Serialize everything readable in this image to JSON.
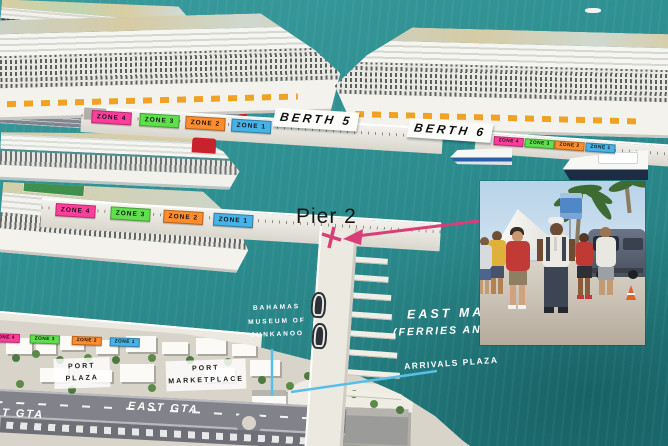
{
  "colors": {
    "water": "#2e8f91",
    "water_dark": "#1e7578",
    "pier": "#ece9e1",
    "land": "#d8d4ca",
    "road": "#81828a",
    "zone_pink": "#ff3d9c",
    "zone_green": "#5fdf4d",
    "zone_orange": "#ff8c2d",
    "zone_blue": "#45b2e8",
    "arrow_pink": "#d83f77",
    "line_blue": "#58bfe8"
  },
  "berths": {
    "berth5": "BERTH 5",
    "berth6": "BERTH 6"
  },
  "pier": {
    "pier2": "Pier 2"
  },
  "zones": {
    "berth5_pier": [
      "ZONE 4",
      "ZONE 3",
      "ZONE 2",
      "ZONE 1"
    ],
    "berth6_pier": [
      "ZONE 4",
      "ZONE 3",
      "ZONE 2",
      "ZONE 1"
    ],
    "pier2": [
      "ZONE 4",
      "ZONE 3",
      "ZONE 2",
      "ZONE 1"
    ],
    "land": [
      "ZONE 4",
      "ZONE 3",
      "ZONE 2",
      "ZONE 1"
    ]
  },
  "annotations": {
    "museum": [
      "BAHAMAS",
      "MUSEUM OF",
      "JUNKANOO"
    ],
    "east_marina": [
      "EAST MARI",
      "(FERRIES AND"
    ],
    "arrivals_plaza": "ARRIVALS PLAZA"
  },
  "land": {
    "port_plaza": [
      "PORT",
      "PLAZA"
    ],
    "port_marketplace": [
      "PORT",
      "MARKETPLACE"
    ],
    "east_gta": "EAST GTA",
    "west_gta_partial": "T GTA"
  }
}
